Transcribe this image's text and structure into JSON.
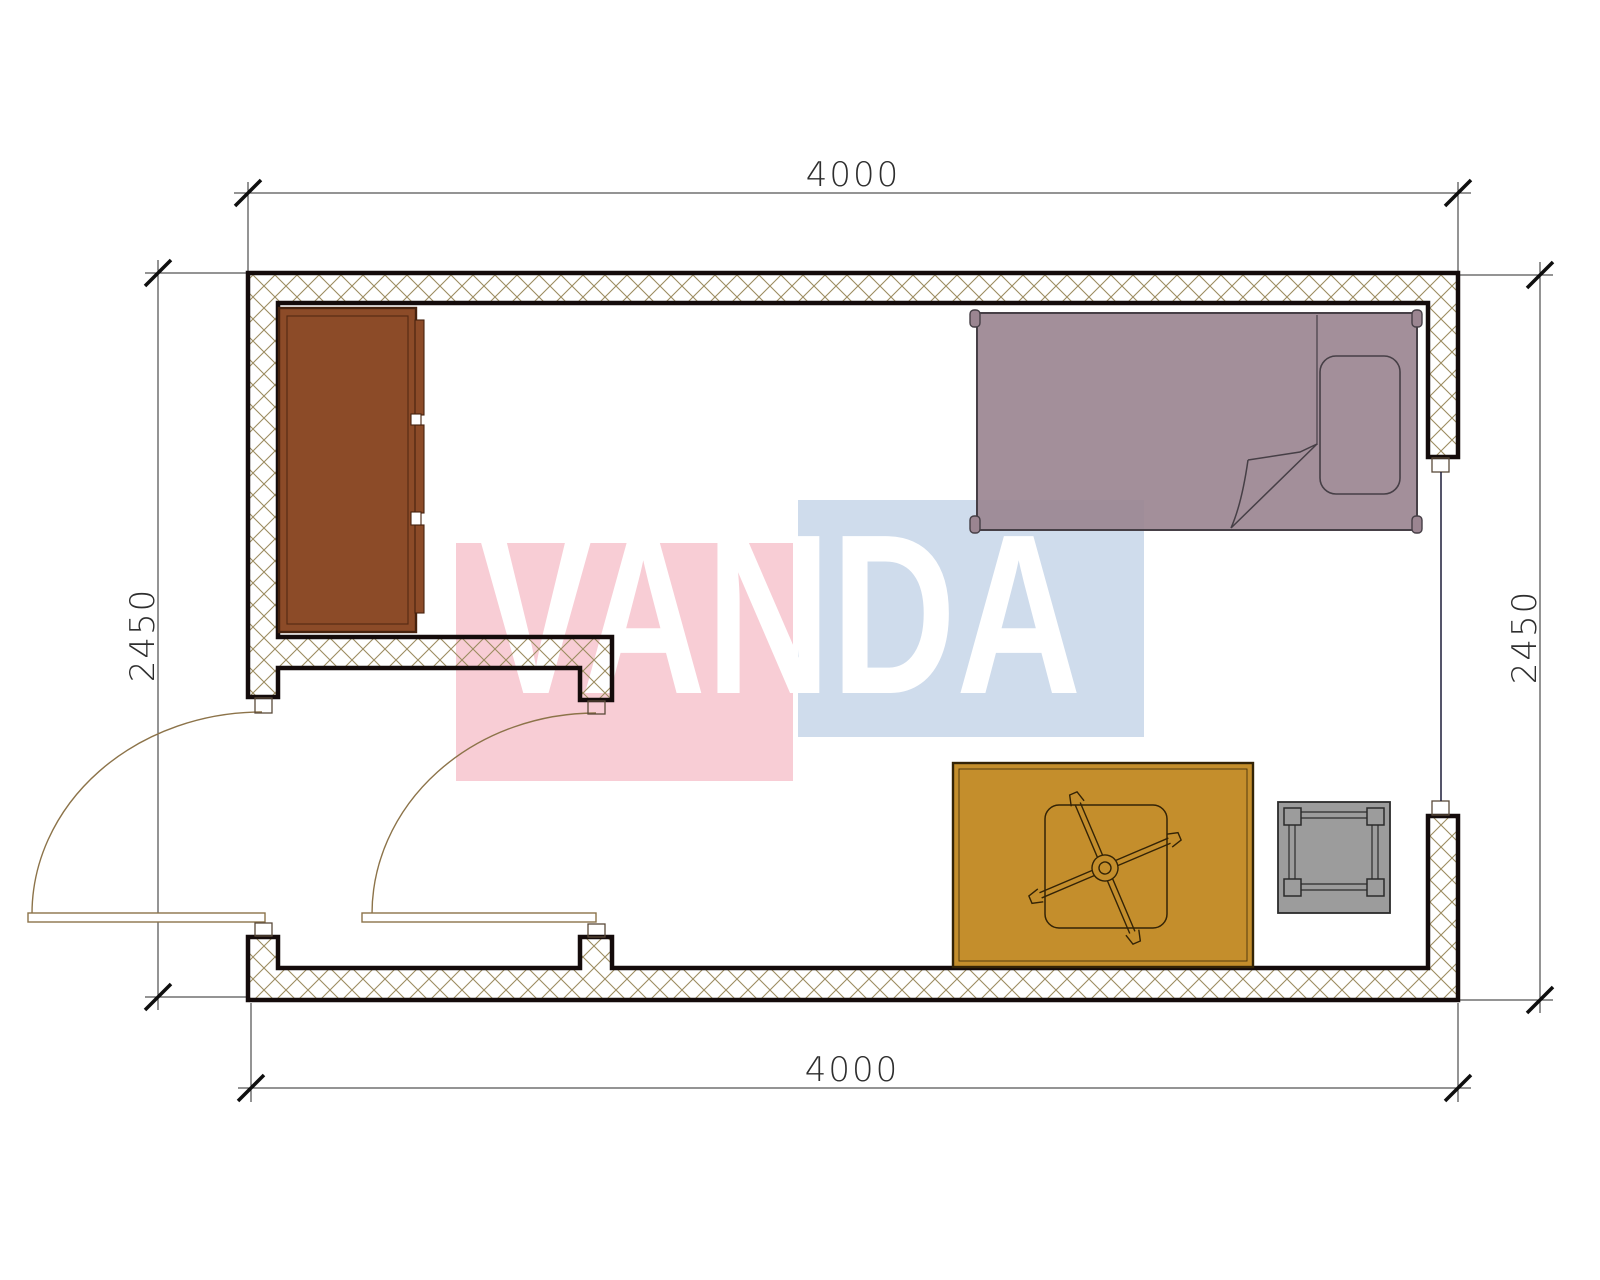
{
  "title": "Single room floor plan 4000 x 2450",
  "watermark": {
    "text": "VANDA"
  },
  "dimensions": {
    "top_width_mm": "4000",
    "bottom_width_mm": "4000",
    "left_height_mm": "2450",
    "right_height_mm": "2450"
  },
  "colors": {
    "watermark-pink": "#f8cdd5",
    "watermark-blue": "#cfdcec",
    "wall-hatch": "#9c8c60",
    "wall-line": "#140b0b",
    "wardrobe": "#8c4b28",
    "wardrobe-line": "#46220e",
    "bed": "#9b8591",
    "bed-line": "#463f46",
    "table": "#c48e2c",
    "table-line": "#332306",
    "stool": "#9c9c9c",
    "stool-line": "#2b2b2b",
    "door": "#8c7349",
    "dim-text": "#2e2e2e"
  },
  "furniture": [
    {
      "name": "wardrobe"
    },
    {
      "name": "single-bed"
    },
    {
      "name": "table-with-swivel-chair"
    },
    {
      "name": "stool"
    }
  ],
  "openings": [
    {
      "name": "entrance-door"
    },
    {
      "name": "interior-door"
    },
    {
      "name": "window"
    }
  ]
}
